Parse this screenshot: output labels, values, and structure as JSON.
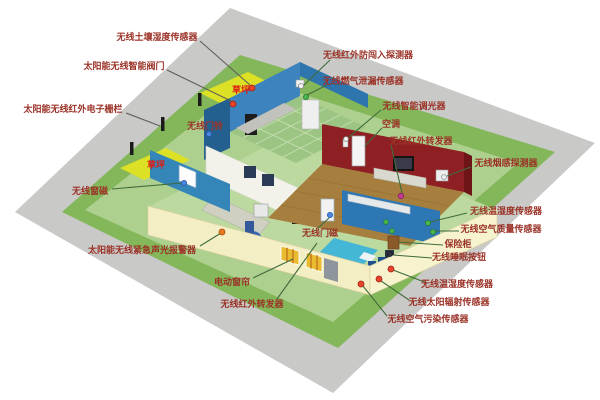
{
  "scene_colors": {
    "background": "#ffffff",
    "concrete": "#c9c9c7",
    "grass": "#84b65a",
    "inner_grass": "#aed08f",
    "house_floor": "#bcd9a0",
    "lawn": "#dde126",
    "lawn_text": "#e01c10",
    "wall_cream": "#f3eec3",
    "wall_cream_light": "#f7f3cf",
    "wall_cream_edge": "#d8d1a2",
    "kitchen_blue": "#2e74ad",
    "kitchen_blue_dark": "#23608f",
    "kitchen_blue_inner": "#3d83bd",
    "kitchen_floor": "#9cc583",
    "teal_wall": "#3486b8",
    "study_wall": "#f2f2ea",
    "red_wall": "#8e2023",
    "red_wall_dark": "#6e1518",
    "wood_floor": "#a67f3e",
    "bedroom_wall": "#2d77b5",
    "bed": "#45b7d6",
    "bed_side": "#2387ab",
    "label_text": "#9b3227",
    "line_green": "#3f6b3c",
    "line_gray": "#5f5f57"
  },
  "labels": [
    {
      "id": "soil-moisture-sensor",
      "text": "无线土壤湿度传感器",
      "x": 157,
      "y": 37,
      "lc": "gray",
      "line": [
        200,
        41,
        250,
        85
      ],
      "dot": {
        "x": 252,
        "y": 88,
        "r": 3,
        "f": "#e8442c",
        "s": "#9c2214"
      }
    },
    {
      "id": "smart-valve",
      "text": "太阳能无线智能阀门",
      "x": 124,
      "y": 66,
      "lc": "gray",
      "line": [
        167,
        70,
        231,
        101
      ],
      "dot": {
        "x": 233,
        "y": 104,
        "r": 3,
        "f": "#e8442c",
        "s": "#9c2214"
      }
    },
    {
      "id": "electronic-fence",
      "text": "太阳能无线红外电子栅栏",
      "x": 73,
      "y": 109,
      "lc": "gray",
      "line": [
        126,
        113,
        160,
        126
      ],
      "dot": null
    },
    {
      "id": "doorbell",
      "text": "无线门铃",
      "x": 205,
      "y": 126,
      "lc": "none",
      "line": null,
      "dot": {
        "x": 209,
        "y": 134,
        "r": 2.6,
        "f": "#4a86e0",
        "s": "#2a57a8"
      }
    },
    {
      "id": "intrusion-detector",
      "text": "无线红外防闯入探测器",
      "x": 368,
      "y": 55,
      "lc": "green",
      "line": [
        330,
        60,
        303,
        86
      ],
      "dot": {
        "x": 301,
        "y": 86,
        "r": 2.6,
        "f": "#f2f2f2",
        "s": "#8a8a8a"
      }
    },
    {
      "id": "gas-leak-sensor",
      "text": "无线燃气泄漏传感器",
      "x": 363,
      "y": 81,
      "lc": "green",
      "line": [
        327,
        85,
        307,
        95
      ],
      "dot": {
        "x": 306,
        "y": 97,
        "r": 2.6,
        "f": "#46b64e",
        "s": "#2c7a33"
      }
    },
    {
      "id": "smart-dimmer",
      "text": "无线智能调光器",
      "x": 414,
      "y": 106,
      "lc": "green",
      "line": [
        381,
        110,
        349,
        137
      ],
      "dot": {
        "x": 346,
        "y": 139,
        "r": 2.4,
        "f": "#f2f2f2",
        "s": "#8a8a8a"
      }
    },
    {
      "id": "air-conditioner",
      "text": "空调",
      "x": 391,
      "y": 124,
      "lc": "green",
      "line": [
        382,
        128,
        365,
        146
      ],
      "dot": null
    },
    {
      "id": "ir-repeater-top",
      "text": "无线红外转发器",
      "x": 421,
      "y": 141,
      "lc": "green",
      "line": [
        391,
        145,
        402,
        193
      ],
      "dot": {
        "x": 401,
        "y": 196,
        "r": 2.8,
        "f": "#c23a8c",
        "s": "#8c2361"
      }
    },
    {
      "id": "smoke-detector",
      "text": "无线烟感探测器",
      "x": 506,
      "y": 163,
      "lc": "green",
      "line": [
        471,
        167,
        447,
        176
      ],
      "dot": {
        "x": 444,
        "y": 177,
        "r": 2.4,
        "f": "#f2f2f2",
        "s": "#8a8a8a"
      }
    },
    {
      "id": "temp-humidity-sensor-right",
      "text": "无线温湿度传感器",
      "x": 506,
      "y": 211,
      "lc": "green",
      "line": [
        467,
        213,
        430,
        222
      ],
      "dot": {
        "x": 428,
        "y": 223,
        "r": 2.6,
        "f": "#46b64e",
        "s": "#2c7a33"
      }
    },
    {
      "id": "air-quality-sensor",
      "text": "无线空气质量传感器",
      "x": 501,
      "y": 229,
      "lc": "green",
      "line": [
        459,
        231,
        435,
        231
      ],
      "dot": {
        "x": 433,
        "y": 232,
        "r": 2.6,
        "f": "#46b64e",
        "s": "#2c7a33"
      }
    },
    {
      "id": "safe-box",
      "text": "保险柜",
      "x": 458,
      "y": 244,
      "lc": "green",
      "line": [
        443,
        245,
        398,
        242
      ],
      "dot": null
    },
    {
      "id": "sleep-button",
      "text": "无线睡眠按钮",
      "x": 459,
      "y": 257,
      "lc": "green",
      "line": [
        432,
        258,
        393,
        255
      ],
      "dot": {
        "x": 390,
        "y": 254,
        "r": 2.4,
        "f": "#2c3340",
        "s": "#14181f"
      }
    },
    {
      "id": "temp-humidity-sensor-bottom",
      "text": "无线温湿度传感器",
      "x": 457,
      "y": 284,
      "lc": "green",
      "line": [
        427,
        283,
        393,
        270
      ],
      "dot": {
        "x": 391,
        "y": 269,
        "r": 3,
        "f": "#e8442c",
        "s": "#9c2214"
      }
    },
    {
      "id": "solar-radiation-sensor",
      "text": "无线太阳辐射传感器",
      "x": 449,
      "y": 302,
      "lc": "green",
      "line": [
        409,
        300,
        381,
        281
      ],
      "dot": {
        "x": 379,
        "y": 279,
        "r": 3,
        "f": "#e8442c",
        "s": "#9c2214"
      }
    },
    {
      "id": "air-pollution-sensor",
      "text": "无线空气污染传感器",
      "x": 428,
      "y": 319,
      "lc": "green",
      "line": [
        387,
        316,
        363,
        286
      ],
      "dot": {
        "x": 361,
        "y": 284,
        "r": 3,
        "f": "#e8442c",
        "s": "#9c2214"
      }
    },
    {
      "id": "door-magnet",
      "text": "无线门磁",
      "x": 320,
      "y": 233,
      "lc": "green",
      "line": [
        318,
        228,
        329,
        218
      ],
      "dot": {
        "x": 330,
        "y": 215,
        "r": 2.6,
        "f": "#4a86e0",
        "s": "#2a57a8"
      }
    },
    {
      "id": "window-magnet",
      "text": "无线窗磁",
      "x": 90,
      "y": 191,
      "lc": "green",
      "line": [
        112,
        189,
        182,
        183
      ],
      "dot": {
        "x": 184,
        "y": 183,
        "r": 2.6,
        "f": "#4a86e0",
        "s": "#2a57a8"
      }
    },
    {
      "id": "lawn-top",
      "text": "草坪",
      "x": 241,
      "y": 90,
      "lc": "none",
      "line": null,
      "dot": null,
      "color": "#e01c10"
    },
    {
      "id": "lawn-left",
      "text": "草坪",
      "x": 156,
      "y": 165,
      "lc": "none",
      "line": null,
      "dot": null,
      "color": "#e01c10"
    },
    {
      "id": "emergency-alarm",
      "text": "太阳能无线紧急声光报警器",
      "x": 142,
      "y": 250,
      "lc": "green",
      "line": [
        200,
        246,
        221,
        233
      ],
      "dot": {
        "x": 222,
        "y": 232,
        "r": 3,
        "f": "#e87820",
        "s": "#a34f0e"
      }
    },
    {
      "id": "electric-curtain",
      "text": "电动窗帘",
      "x": 232,
      "y": 282,
      "lc": "green",
      "line": [
        253,
        278,
        293,
        259
      ],
      "dot": null
    },
    {
      "id": "ir-repeater-bottom",
      "text": "无线红外转发器",
      "x": 252,
      "y": 304,
      "lc": "green",
      "line": [
        277,
        299,
        317,
        243
      ],
      "dot": null
    }
  ]
}
